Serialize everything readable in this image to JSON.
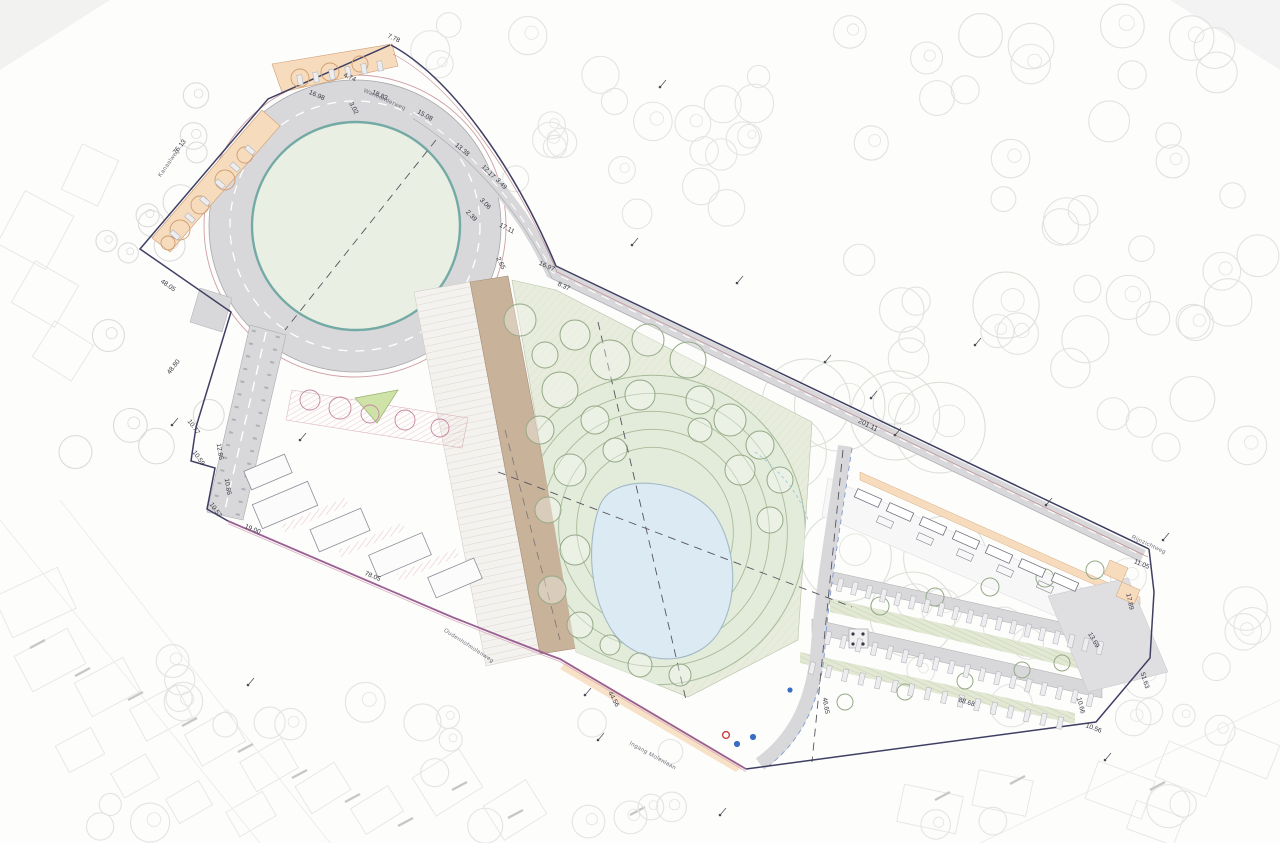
{
  "drawing": {
    "kind": "landscape site plan",
    "labels": {
      "dimensions": [
        {
          "text": "7.78",
          "x": 393,
          "y": 40,
          "rot": 24
        },
        {
          "text": "4.74",
          "x": 349,
          "y": 79,
          "rot": 24
        },
        {
          "text": "16.98",
          "x": 316,
          "y": 97,
          "rot": 24
        },
        {
          "text": "3.02",
          "x": 352,
          "y": 109,
          "rot": 62
        },
        {
          "text": "18.83",
          "x": 379,
          "y": 97,
          "rot": 24
        },
        {
          "text": "15.08",
          "x": 424,
          "y": 117,
          "rot": 30
        },
        {
          "text": "13.38",
          "x": 461,
          "y": 151,
          "rot": 40
        },
        {
          "text": "12.17",
          "x": 487,
          "y": 173,
          "rot": 46
        },
        {
          "text": "3.49",
          "x": 500,
          "y": 185,
          "rot": 46
        },
        {
          "text": "3.06",
          "x": 484,
          "y": 205,
          "rot": 46
        },
        {
          "text": "2.39",
          "x": 470,
          "y": 217,
          "rot": 46
        },
        {
          "text": "17.11",
          "x": 506,
          "y": 230,
          "rot": 28
        },
        {
          "text": "2.65",
          "x": 499,
          "y": 264,
          "rot": 64
        },
        {
          "text": "16.97",
          "x": 546,
          "y": 268,
          "rot": 25
        },
        {
          "text": "8.37",
          "x": 563,
          "y": 288,
          "rot": 25
        },
        {
          "text": "76.13",
          "x": 181,
          "y": 148,
          "rot": -52
        },
        {
          "text": "48.05",
          "x": 167,
          "y": 287,
          "rot": 35
        },
        {
          "text": "48.80",
          "x": 175,
          "y": 368,
          "rot": -52
        },
        {
          "text": "10.77",
          "x": 192,
          "y": 428,
          "rot": 55
        },
        {
          "text": "10.59",
          "x": 197,
          "y": 459,
          "rot": 55
        },
        {
          "text": "12.86",
          "x": 218,
          "y": 452,
          "rot": 80
        },
        {
          "text": "10.86",
          "x": 226,
          "y": 487,
          "rot": 80
        },
        {
          "text": "10.57",
          "x": 214,
          "y": 511,
          "rot": 55
        },
        {
          "text": "19.00",
          "x": 252,
          "y": 531,
          "rot": 22
        },
        {
          "text": "78.05",
          "x": 372,
          "y": 578,
          "rot": 23
        },
        {
          "text": "44.56",
          "x": 612,
          "y": 700,
          "rot": 62
        },
        {
          "text": "46.65",
          "x": 824,
          "y": 706,
          "rot": 80
        },
        {
          "text": "201.11",
          "x": 867,
          "y": 427,
          "rot": 26
        },
        {
          "text": "11.05",
          "x": 1141,
          "y": 566,
          "rot": 22
        },
        {
          "text": "17.89",
          "x": 1128,
          "y": 602,
          "rot": 78
        },
        {
          "text": "13.69",
          "x": 1092,
          "y": 641,
          "rot": 60
        },
        {
          "text": "51.63",
          "x": 1143,
          "y": 681,
          "rot": 72
        },
        {
          "text": "88.68",
          "x": 966,
          "y": 704,
          "rot": 18
        },
        {
          "text": "10.66",
          "x": 1079,
          "y": 706,
          "rot": 75
        },
        {
          "text": "10.56",
          "x": 1093,
          "y": 730,
          "rot": 20
        }
      ],
      "streets": [
        {
          "text": "Warmonderweg",
          "x": 384,
          "y": 101,
          "rot": 24
        },
        {
          "text": "Rijnzichtweg",
          "x": 1148,
          "y": 546,
          "rot": 25
        },
        {
          "text": "Oudenhofmolenweg",
          "x": 468,
          "y": 647,
          "rot": 33
        },
        {
          "text": "Ingang Molenlaan",
          "x": 652,
          "y": 757,
          "rot": 29
        },
        {
          "text": "Kanaalweg",
          "x": 170,
          "y": 164,
          "rot": -55
        }
      ]
    },
    "colors": {
      "paper": "#fdfdfc",
      "boundary": "#3f3f63",
      "boundary_red": "#bb7880",
      "south_boundary": "#9a5f93",
      "south_boundary_echo": "#d9aebc",
      "road": "#d8d8db",
      "road_edge": "#a7a7ad",
      "green_field": "#e9efe2",
      "field_rim": "#74aaa5",
      "park": "#e7ecdc",
      "park_hatch": "#ccd6bd",
      "verge": "#e2e8d4",
      "pond": "#dcebf3",
      "pond_edge": "#a3b9c6",
      "terrace": "#a9bb9b",
      "parking_bay": "#f6dcbd",
      "bay_edge": "#cf9d72",
      "pink_hatch": "#dfa8b2",
      "plaza": "#f4f2ef",
      "strip_brown": "#c9b29a",
      "building": "#dfdfe2",
      "tree_bg": "#e3e3e3",
      "tree_site": "#95a987",
      "sign_blue": "#3a6ec2",
      "sign_red": "#c94040",
      "dash_axis": "#55555f",
      "cable_blue": "#7d9cd1"
    }
  }
}
